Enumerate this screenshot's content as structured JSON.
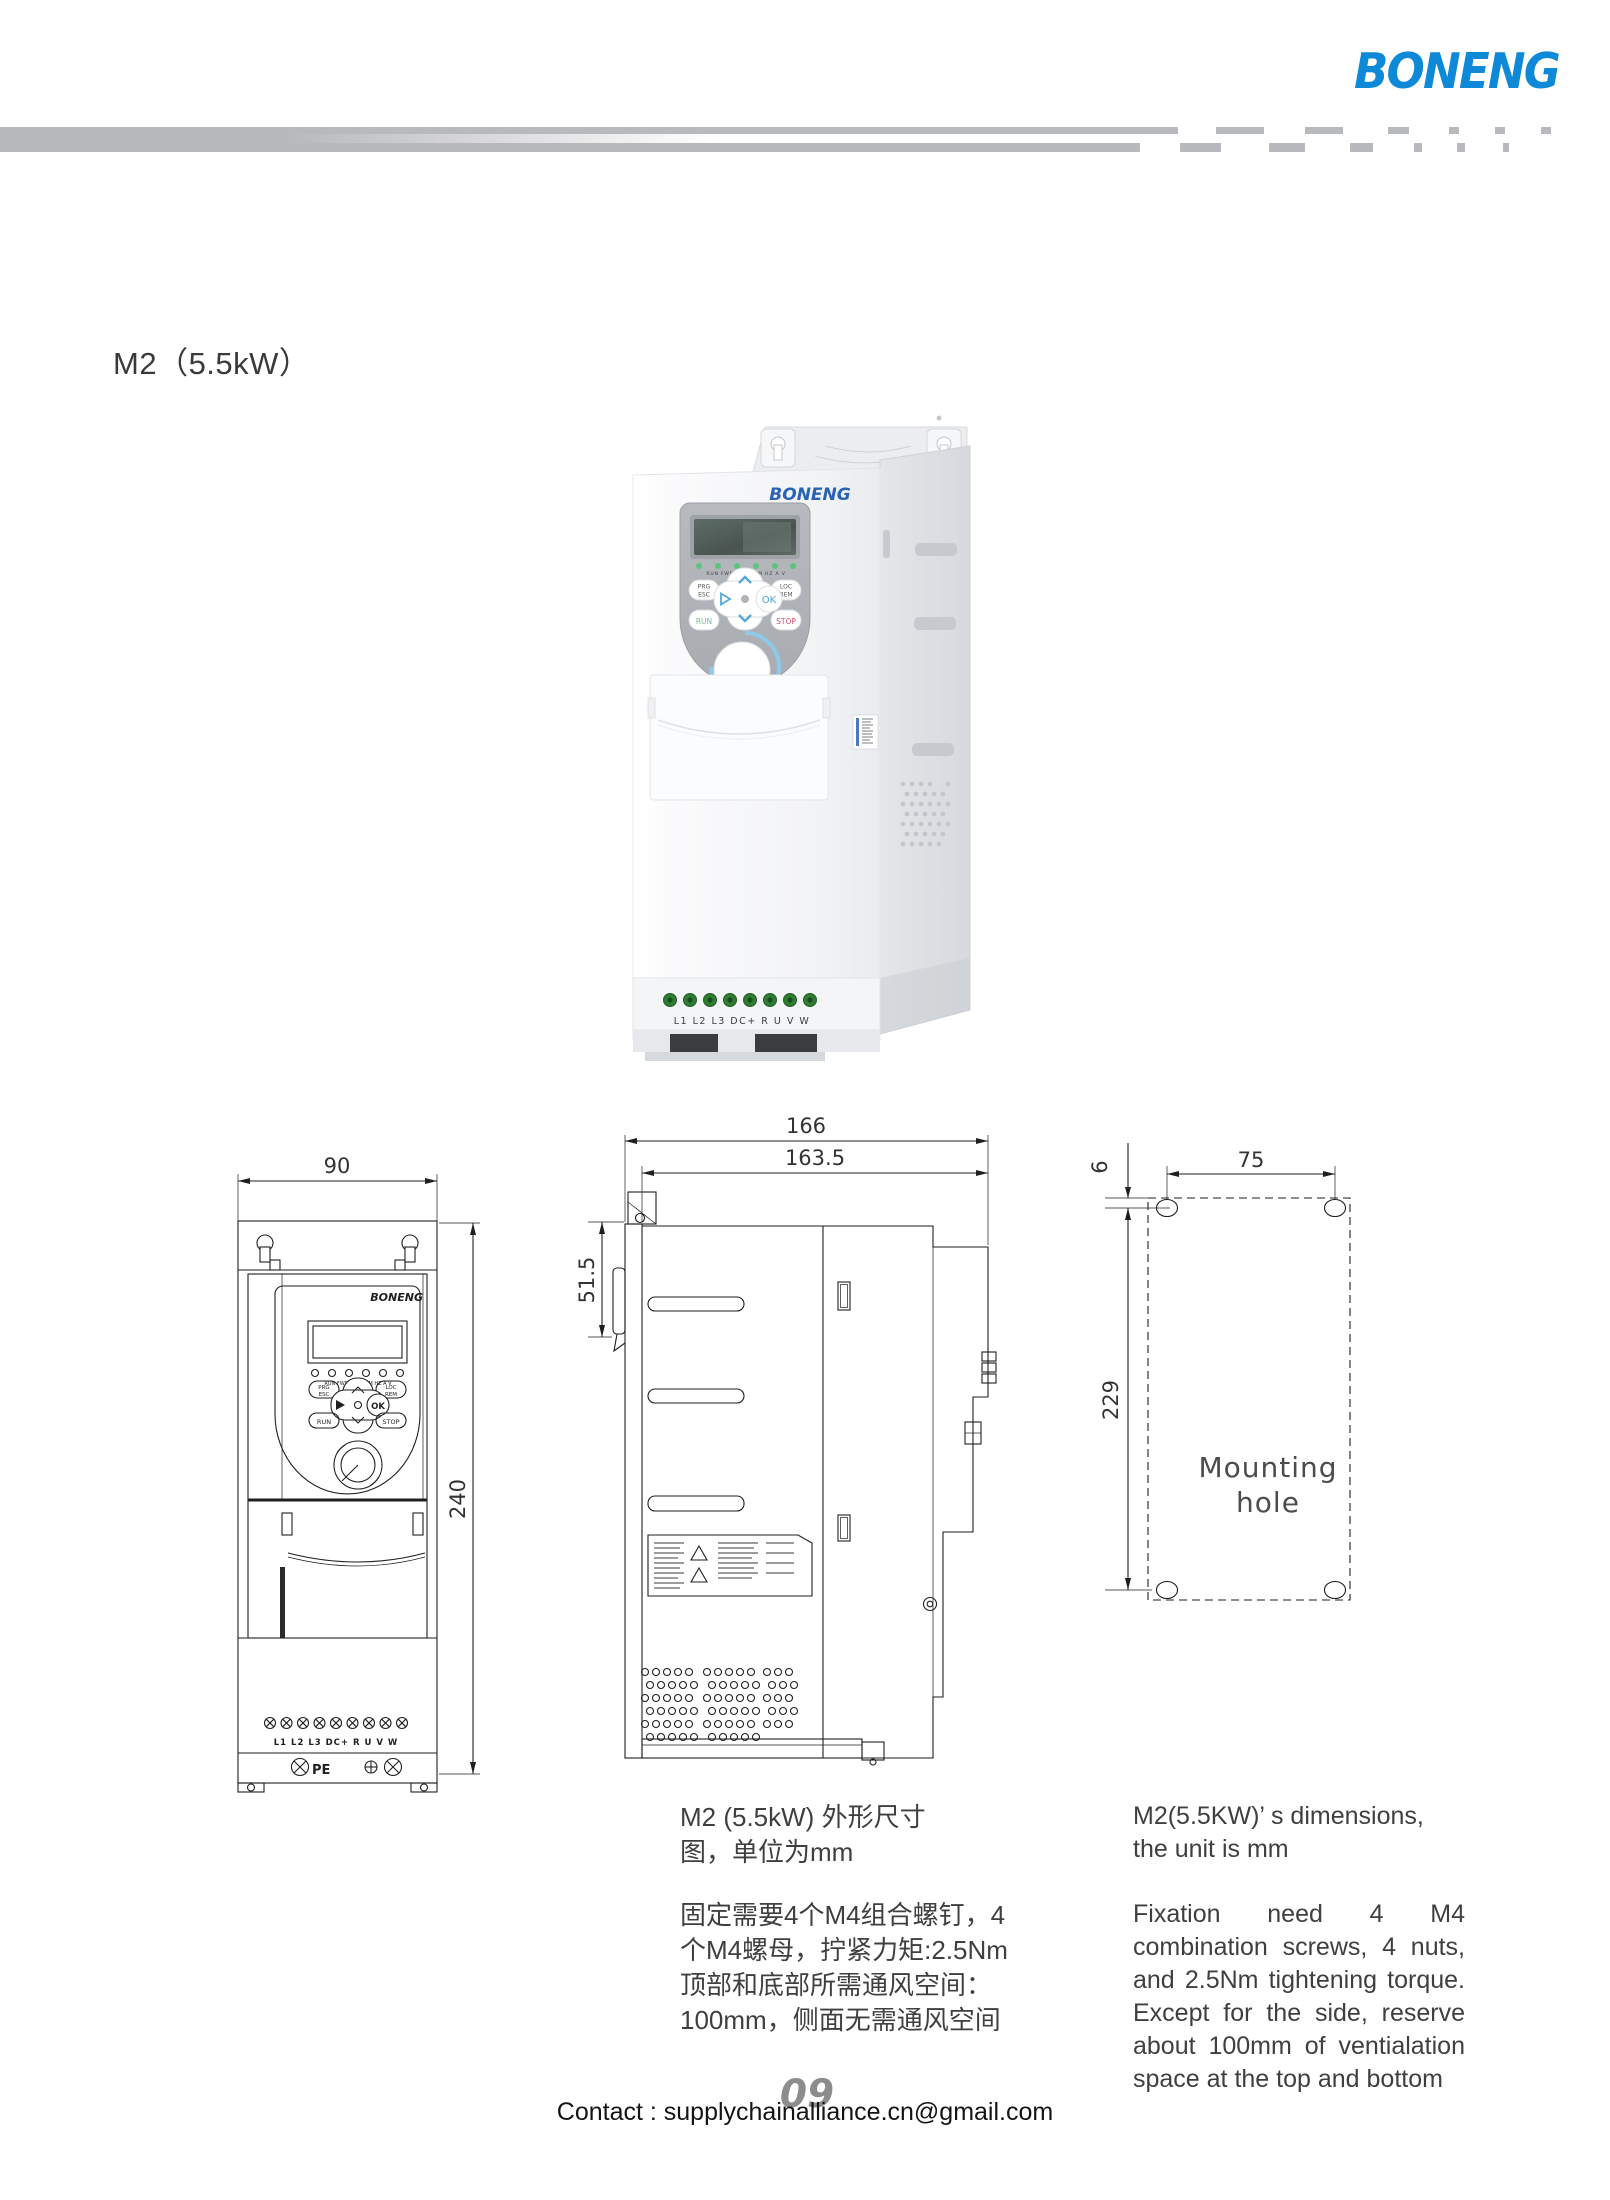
{
  "brand": {
    "name": "BONENG",
    "color": "#0e89d7",
    "device_logo_color": "#2a62b5"
  },
  "page": {
    "title": "M2（5.5kW）",
    "page_number": "09",
    "contact": "Contact : supplychainalliance.cn@gmail.com"
  },
  "device": {
    "logo": "BONENG",
    "leds_labels": "RUN FWD LOC/REM HZ A V",
    "keys": {
      "prg": "PRG",
      "esc": "ESC",
      "loc": "LOC",
      "rem": "REM",
      "ok": "OK",
      "run": "RUN",
      "stop": "STOP"
    },
    "terminals": "L1  L2  L3 DC+  R   U   V   W",
    "status_led_color": "#5bc47c",
    "run_color": "#76bd92",
    "stop_color": "#d4506b",
    "arrow_color": "#56a8dc"
  },
  "front_view": {
    "dim_width": "90",
    "dim_height": "240",
    "pe": "PE"
  },
  "side_view": {
    "dim_total": "166",
    "dim_body": "163.5",
    "dim_back": "51.5"
  },
  "mounting_view": {
    "dim_top_offset": "6",
    "dim_hole_spacing": "75",
    "dim_hole_vertical": "229",
    "label_line1": "Mounting",
    "label_line2": "hole"
  },
  "captions": {
    "cn": [
      "M2 (5.5kW) 外形尺寸",
      "图，单位为mm",
      "固定需要4个M4组合螺钉，4",
      "个M4螺母，拧紧力矩:2.5Nm",
      "顶部和底部所需通风空间：",
      "100mm，侧面无需通风空间"
    ],
    "en": [
      "M2(5.5KW)’ s dimensions,",
      "the unit is mm",
      "Fixation need 4 M4",
      "combination screws, 4 nuts,",
      "and 2.5Nm tightening torque.",
      "Except for the side, reserve",
      "about 100mm of ventialation",
      "space at the top and bottom"
    ]
  }
}
